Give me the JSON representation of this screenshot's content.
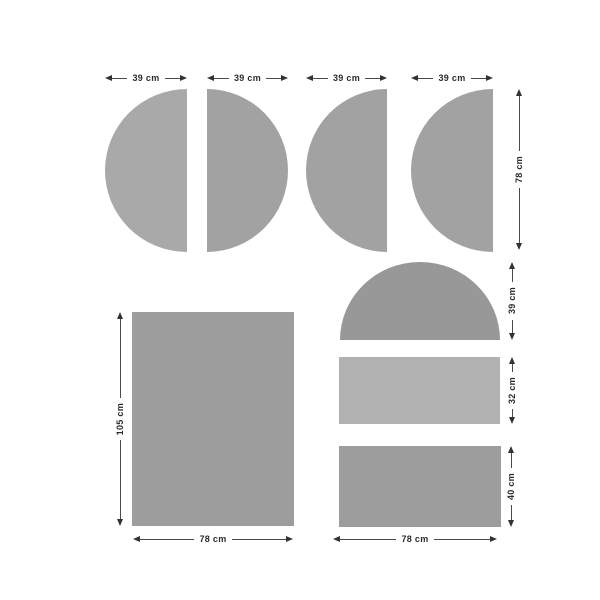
{
  "colors": {
    "background": "#ffffff",
    "dim_line": "#4a4a4a",
    "dim_text": "#2b2b2b"
  },
  "shapes": [
    {
      "name": "semicircle-left-1",
      "fill": "#a9a9a9"
    },
    {
      "name": "semicircle-right",
      "fill": "#a2a2a2"
    },
    {
      "name": "semicircle-left-2",
      "fill": "#a2a2a2"
    },
    {
      "name": "semicircle-left-3",
      "fill": "#a2a2a2"
    },
    {
      "name": "dome-semicircle",
      "fill": "#989898"
    },
    {
      "name": "middle-rectangle",
      "fill": "#b1b1b1"
    },
    {
      "name": "lower-rectangle",
      "fill": "#9d9d9d"
    },
    {
      "name": "large-rectangle",
      "fill": "#9d9d9d"
    }
  ],
  "dims": {
    "semicircle_width_1": "39 cm",
    "semicircle_width_2": "39 cm",
    "semicircle_width_3": "39 cm",
    "semicircle_width_4": "39 cm",
    "semicircle_row_height": "78 cm",
    "dome_height": "39 cm",
    "middle_rect_height": "32 cm",
    "lower_rect_height": "40 cm",
    "large_rect_height": "105 cm",
    "large_rect_width": "78 cm",
    "right_column_width": "78 cm"
  }
}
